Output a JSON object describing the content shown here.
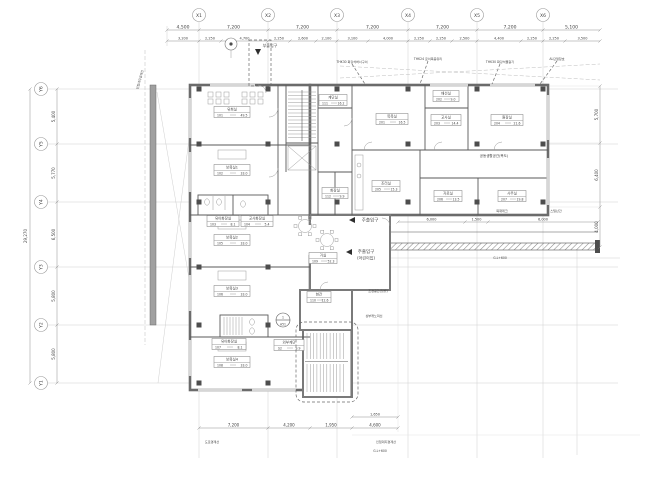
{
  "grid": {
    "x_labels": [
      "X1",
      "X2",
      "X3",
      "X4",
      "X5",
      "X6"
    ],
    "y_labels_left": [
      "Y6",
      "Y5",
      "Y4",
      "Y3",
      "Y2",
      "Y1"
    ]
  },
  "dims": {
    "top_main": [
      "4,500",
      "7,200",
      "7,200",
      "7,200",
      "7,200",
      "7,200",
      "5,100"
    ],
    "top_sub": [
      "3,200",
      "2,250",
      "4,700",
      "2,250",
      "2,600",
      "2,100",
      "3,100",
      "4,000",
      "2,250",
      "2,250",
      "2,500",
      "4,400",
      "2,250",
      "2,250",
      "3,500"
    ],
    "left_main": [
      "5,400",
      "5,770",
      "6,500",
      "5,800",
      "5,800"
    ],
    "left_total": "29,270",
    "right_main": [
      "5,700",
      "6,400",
      "4,000"
    ],
    "bottom_main": [
      "7,200",
      "4,200",
      "1,950",
      "4,600"
    ],
    "bottom_sub": [
      "1,650"
    ],
    "east_walk": [
      "6,000",
      "1,500",
      "6,000"
    ]
  },
  "rooms": [
    {
      "name": "유희실",
      "code": "101",
      "area": "49.5",
      "cx": 232,
      "cy": 112,
      "w": 36
    },
    {
      "name": "보육실1",
      "code": "102",
      "area": "33.0",
      "cx": 232,
      "cy": 170,
      "w": 36
    },
    {
      "name": "유아화장실",
      "code": "103",
      "area": "8.1",
      "cx": 223,
      "cy": 221,
      "w": 32
    },
    {
      "name": "교사화장실",
      "code": "104",
      "area": "5.4",
      "cx": 257,
      "cy": 221,
      "w": 32
    },
    {
      "name": "보육실2",
      "code": "105",
      "area": "33.0",
      "cx": 232,
      "cy": 240,
      "w": 36
    },
    {
      "name": "보육실3",
      "code": "106",
      "area": "33.0",
      "cx": 232,
      "cy": 291,
      "w": 36
    },
    {
      "name": "유아화장실",
      "code": "107",
      "area": "8.1",
      "cx": 229,
      "cy": 344,
      "w": 34
    },
    {
      "name": "보육실4",
      "code": "108",
      "area": "33.0",
      "cx": 232,
      "cy": 362,
      "w": 36
    },
    {
      "name": "거실",
      "code": "109",
      "area": "52.3",
      "cx": 323,
      "cy": 258,
      "w": 28
    },
    {
      "name": "현관",
      "code": "110",
      "area": "12.6",
      "cx": 319,
      "cy": 297,
      "w": 24
    },
    {
      "name": "계단실",
      "code": "111",
      "area": "16.2",
      "cx": 333,
      "cy": 100,
      "w": 28
    },
    {
      "name": "화장실",
      "code": "112",
      "area": "9.9",
      "cx": 335,
      "cy": 193,
      "w": 26
    },
    {
      "name": "목욕실",
      "code": "201",
      "area": "16.5",
      "cx": 392,
      "cy": 119,
      "w": 32
    },
    {
      "name": "배선실",
      "code": "202",
      "area": "9.0",
      "cx": 446,
      "cy": 96,
      "w": 26
    },
    {
      "name": "교사실",
      "code": "203",
      "area": "14.4",
      "cx": 446,
      "cy": 120,
      "w": 30
    },
    {
      "name": "원장실",
      "code": "204",
      "area": "21.6",
      "cx": 507,
      "cy": 120,
      "w": 32
    },
    {
      "name": "조리실",
      "code": "205",
      "area": "15.3",
      "cx": 386,
      "cy": 186,
      "w": 28
    },
    {
      "name": "자료실",
      "code": "206",
      "area": "13.5",
      "cx": 448,
      "cy": 196,
      "w": 28
    },
    {
      "name": "사무실",
      "code": "207",
      "area": "19.8",
      "cx": 512,
      "cy": 196,
      "w": 28
    },
    {
      "name": "외부계단",
      "code": "S2",
      "area": "9.9",
      "cx": 289,
      "cy": 345,
      "w": 30
    }
  ],
  "corridor_note": "공동생활공간(복도)",
  "entrances": {
    "main_label": "주출입구",
    "main_sub": "(어린이집)",
    "side_label": "주출입구",
    "rear_label": "부출입구"
  },
  "finish_notes": [
    "THK30 화강석버너구이",
    "THK24 로이복층유리",
    "THK30 화강석물갈기",
    "AL단열창호"
  ],
  "site_notes": [
    {
      "text": "인접대지경계선",
      "x": 141,
      "y": 80,
      "rot": -75
    },
    {
      "text": "도로경계선",
      "x": 212,
      "y": 443,
      "rot": 0
    },
    {
      "text": "인접대지경계선",
      "x": 386,
      "y": 443,
      "rot": 0
    },
    {
      "text": "목재데크",
      "x": 502,
      "y": 212,
      "rot": 0
    },
    {
      "text": "스틸난간",
      "x": 556,
      "y": 212,
      "rot": 0
    },
    {
      "text": "조경공간(텃밭)",
      "x": 378,
      "y": 292,
      "rot": 0
    },
    {
      "text": "상부캐노피선",
      "x": 374,
      "y": 317,
      "rot": 0
    },
    {
      "text": "G.L+600",
      "x": 500,
      "y": 259,
      "rot": 0
    },
    {
      "text": "G.L+600",
      "x": 380,
      "y": 452,
      "rot": 0
    }
  ],
  "detail_marker": {
    "num": "1",
    "sheet": "A51"
  }
}
